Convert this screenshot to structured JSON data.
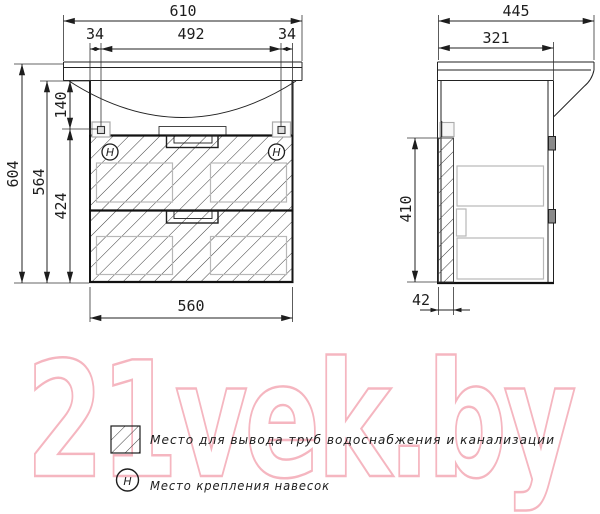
{
  "watermark": {
    "text": "21vek.by",
    "color": "#f5b6c0"
  },
  "front_view": {
    "dim_width_top": "610",
    "dim_offset_left": "34",
    "dim_center_span": "492",
    "dim_offset_right": "34",
    "dim_height_total": "604",
    "dim_height_carcass": "564",
    "dim_hanger_drop": "140",
    "dim_lower_height": "424",
    "dim_width_bottom": "560",
    "hanger_mark": "H"
  },
  "side_view": {
    "dim_depth_top": "445",
    "dim_depth_carcass": "321",
    "dim_back_height": "410",
    "dim_back_offset": "42"
  },
  "legend": {
    "pipes": {
      "label": "Место для вывода труб водоснабжения и канализации"
    },
    "hangers": {
      "symbol": "H",
      "label": "Место крепления навесок"
    }
  },
  "colors": {
    "line": "#222222",
    "gray_detail": "#b8b8b8",
    "watermark_pink": "#f5b6c0"
  }
}
